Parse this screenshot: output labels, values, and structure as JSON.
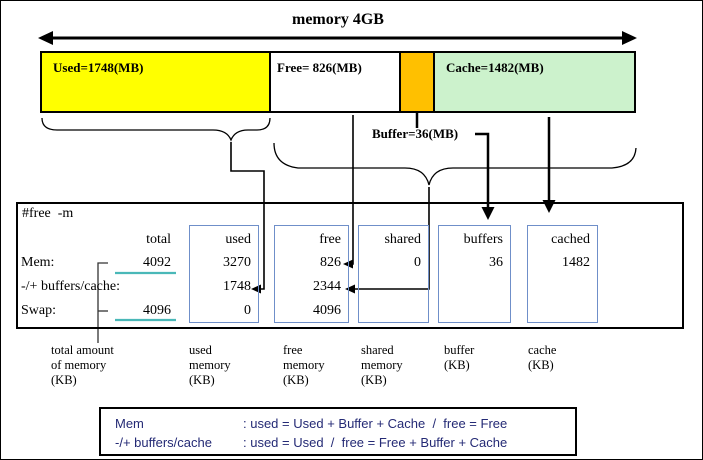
{
  "title": "memory 4GB",
  "bar": {
    "segments": [
      {
        "name": "used",
        "label": "Used=1748(MB)",
        "color": "#ffff00"
      },
      {
        "name": "free",
        "label": "Free= 826(MB)",
        "color": "#ffffff"
      },
      {
        "name": "buffer",
        "label": "",
        "color": "#ffc000"
      },
      {
        "name": "cache",
        "label": "Cache=1482(MB)",
        "color": "#ccf2cc"
      }
    ],
    "buffer_label": "Buffer=36(MB)"
  },
  "terminal": {
    "command": "#free  -m",
    "columns": [
      "total",
      "used",
      "free",
      "shared",
      "buffers",
      "cached"
    ],
    "rows": [
      {
        "label": "Mem:",
        "total": "4092",
        "used": "3270",
        "free": "826",
        "shared": "0",
        "buffers": "36",
        "cached": "1482"
      },
      {
        "label": "-/+ buffers/cache:",
        "total": "",
        "used": "1748",
        "free": "2344",
        "shared": "",
        "buffers": "",
        "cached": ""
      },
      {
        "label": "Swap:",
        "total": "4096",
        "used": "0",
        "free": "4096",
        "shared": "",
        "buffers": "",
        "cached": ""
      }
    ]
  },
  "legend": [
    {
      "lines": [
        "total amount",
        "of memory",
        "(KB)"
      ]
    },
    {
      "lines": [
        "used",
        "memory",
        "(KB)"
      ]
    },
    {
      "lines": [
        "free",
        "memory",
        "(KB)"
      ]
    },
    {
      "lines": [
        "shared",
        "memory",
        "(KB)"
      ]
    },
    {
      "lines": [
        "buffer",
        "(KB)"
      ]
    },
    {
      "lines": [
        "cache",
        "(KB)"
      ]
    }
  ],
  "formulas": [
    {
      "name": "Mem",
      "rule": ": used = Used + Buffer + Cache  /  free = Free"
    },
    {
      "name": "-/+ buffers/cache",
      "rule": ": used = Used  /  free = Free + Buffer + Cache"
    }
  ],
  "colors": {
    "used_segment": "#ffff00",
    "buffer_segment": "#ffc000",
    "cache_segment": "#ccf2cc",
    "column_box_border": "#6f8fc9",
    "total_underline": "#4ab8b8",
    "formula_text": "#242a75"
  }
}
